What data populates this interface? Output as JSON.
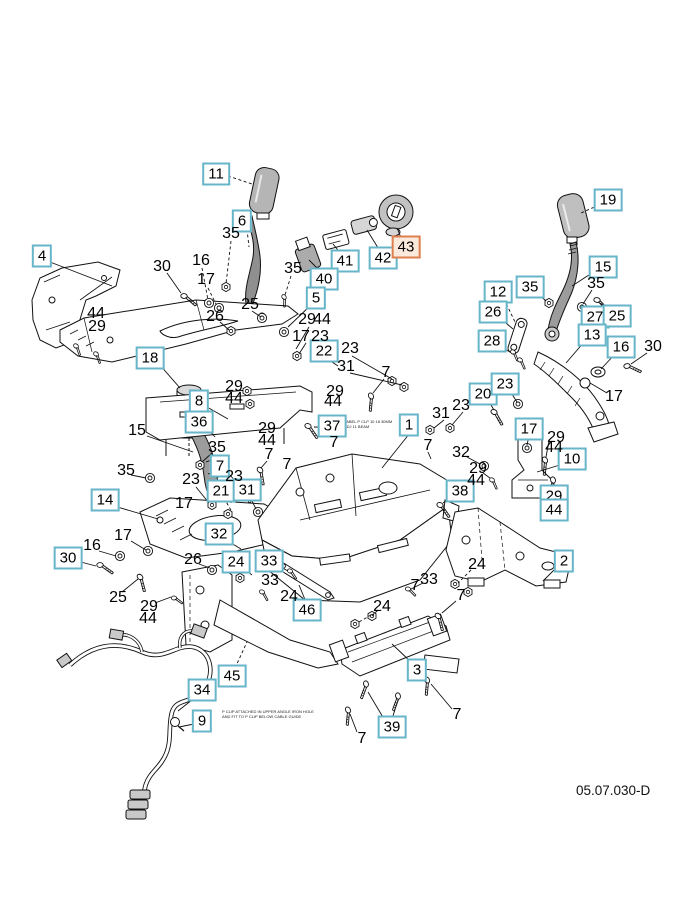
{
  "diagram": {
    "code": "05.07.030-D",
    "colors": {
      "callout_border": "#67b5c8",
      "highlight_border": "#dd7f4e",
      "highlight_bg": "#fbe9dc",
      "ink": "#111111"
    },
    "notes": [
      {
        "x": 344,
        "y": 419,
        "lines": [
          "LABEL P CLP 10 18 30MM",
          "ADJ 11 BEAM"
        ]
      },
      {
        "x": 222,
        "y": 709,
        "lines": [
          "P CLIP ATTACHED IN UPPER ANGLE IRON HOLE",
          "AND FIT TO P CLIP BELOW CABLE GUIDE"
        ]
      }
    ],
    "callouts": [
      {
        "n": "4",
        "x": 42,
        "y": 256,
        "boxed": true
      },
      {
        "n": "11",
        "x": 216,
        "y": 174,
        "boxed": true
      },
      {
        "n": "6",
        "x": 242,
        "y": 221,
        "boxed": true
      },
      {
        "n": "41",
        "x": 345,
        "y": 261,
        "boxed": true
      },
      {
        "n": "42",
        "x": 383,
        "y": 258,
        "boxed": true
      },
      {
        "n": "43",
        "x": 406,
        "y": 247,
        "boxed": true,
        "highlight": true
      },
      {
        "n": "40",
        "x": 324,
        "y": 279,
        "boxed": true
      },
      {
        "n": "5",
        "x": 316,
        "y": 298,
        "boxed": true
      },
      {
        "n": "19",
        "x": 608,
        "y": 200,
        "boxed": true
      },
      {
        "n": "15",
        "x": 603,
        "y": 267,
        "boxed": true
      },
      {
        "n": "35",
        "x": 530,
        "y": 287,
        "boxed": true
      },
      {
        "n": "12",
        "x": 498,
        "y": 292,
        "boxed": true
      },
      {
        "n": "26",
        "x": 493,
        "y": 312,
        "boxed": true
      },
      {
        "n": "27",
        "x": 595,
        "y": 317,
        "boxed": true
      },
      {
        "n": "25",
        "x": 617,
        "y": 316,
        "boxed": true
      },
      {
        "n": "28",
        "x": 492,
        "y": 341,
        "boxed": true
      },
      {
        "n": "13",
        "x": 592,
        "y": 335,
        "boxed": true
      },
      {
        "n": "16",
        "x": 621,
        "y": 347,
        "boxed": true
      },
      {
        "n": "18",
        "x": 150,
        "y": 358,
        "boxed": true
      },
      {
        "n": "8",
        "x": 199,
        "y": 401,
        "boxed": true
      },
      {
        "n": "36",
        "x": 199,
        "y": 422,
        "boxed": true
      },
      {
        "n": "22",
        "x": 324,
        "y": 351,
        "boxed": true
      },
      {
        "n": "37",
        "x": 332,
        "y": 426,
        "boxed": true
      },
      {
        "n": "1",
        "x": 409,
        "y": 425,
        "boxed": true
      },
      {
        "n": "20",
        "x": 483,
        "y": 394,
        "boxed": true
      },
      {
        "n": "23",
        "x": 505,
        "y": 384,
        "boxed": true
      },
      {
        "n": "17",
        "x": 529,
        "y": 429,
        "boxed": true
      },
      {
        "n": "10",
        "x": 572,
        "y": 459,
        "boxed": true
      },
      {
        "n": "38",
        "x": 460,
        "y": 491,
        "boxed": true
      },
      {
        "n": "29",
        "x": 554,
        "y": 496,
        "boxed": true
      },
      {
        "n": "44",
        "x": 554,
        "y": 510,
        "boxed": true
      },
      {
        "n": "7",
        "x": 220,
        "y": 466,
        "boxed": true
      },
      {
        "n": "21",
        "x": 221,
        "y": 491,
        "boxed": true
      },
      {
        "n": "31",
        "x": 247,
        "y": 490,
        "boxed": true
      },
      {
        "n": "14",
        "x": 105,
        "y": 500,
        "boxed": true
      },
      {
        "n": "30",
        "x": 68,
        "y": 558,
        "boxed": true
      },
      {
        "n": "32",
        "x": 219,
        "y": 534,
        "boxed": true
      },
      {
        "n": "24",
        "x": 236,
        "y": 562,
        "boxed": true
      },
      {
        "n": "33",
        "x": 269,
        "y": 561,
        "boxed": true
      },
      {
        "n": "46",
        "x": 307,
        "y": 610,
        "boxed": true
      },
      {
        "n": "2",
        "x": 564,
        "y": 561,
        "boxed": true
      },
      {
        "n": "45",
        "x": 232,
        "y": 676,
        "boxed": true
      },
      {
        "n": "34",
        "x": 202,
        "y": 690,
        "boxed": true
      },
      {
        "n": "9",
        "x": 202,
        "y": 721,
        "boxed": true
      },
      {
        "n": "3",
        "x": 417,
        "y": 670,
        "boxed": true
      },
      {
        "n": "39",
        "x": 392,
        "y": 727,
        "boxed": true
      },
      {
        "n": "30",
        "x": 162,
        "y": 267,
        "boxed": false
      },
      {
        "n": "16",
        "x": 201,
        "y": 261,
        "boxed": false
      },
      {
        "n": "17",
        "x": 206,
        "y": 280,
        "boxed": false
      },
      {
        "n": "35",
        "x": 231,
        "y": 234,
        "boxed": false
      },
      {
        "n": "35",
        "x": 293,
        "y": 269,
        "boxed": false
      },
      {
        "n": "44",
        "x": 96,
        "y": 314,
        "boxed": false
      },
      {
        "n": "29",
        "x": 97,
        "y": 327,
        "boxed": false
      },
      {
        "n": "26",
        "x": 215,
        "y": 317,
        "boxed": false
      },
      {
        "n": "25",
        "x": 250,
        "y": 305,
        "boxed": false
      },
      {
        "n": "29",
        "x": 307,
        "y": 320,
        "boxed": false
      },
      {
        "n": "44",
        "x": 322,
        "y": 320,
        "boxed": false
      },
      {
        "n": "17",
        "x": 301,
        "y": 337,
        "boxed": false
      },
      {
        "n": "23",
        "x": 320,
        "y": 337,
        "boxed": false
      },
      {
        "n": "23",
        "x": 350,
        "y": 349,
        "boxed": false
      },
      {
        "n": "31",
        "x": 346,
        "y": 367,
        "boxed": false
      },
      {
        "n": "7",
        "x": 386,
        "y": 373,
        "boxed": false
      },
      {
        "n": "35",
        "x": 596,
        "y": 284,
        "boxed": false
      },
      {
        "n": "30",
        "x": 653,
        "y": 347,
        "boxed": false
      },
      {
        "n": "17",
        "x": 614,
        "y": 397,
        "boxed": false
      },
      {
        "n": "29",
        "x": 234,
        "y": 387,
        "boxed": false
      },
      {
        "n": "44",
        "x": 234,
        "y": 399,
        "boxed": false
      },
      {
        "n": "29",
        "x": 267,
        "y": 429,
        "boxed": false
      },
      {
        "n": "44",
        "x": 267,
        "y": 441,
        "boxed": false
      },
      {
        "n": "35",
        "x": 217,
        "y": 448,
        "boxed": false
      },
      {
        "n": "7",
        "x": 269,
        "y": 455,
        "boxed": false
      },
      {
        "n": "23",
        "x": 191,
        "y": 480,
        "boxed": false
      },
      {
        "n": "23",
        "x": 234,
        "y": 477,
        "boxed": false
      },
      {
        "n": "29",
        "x": 335,
        "y": 392,
        "boxed": false
      },
      {
        "n": "44",
        "x": 333,
        "y": 402,
        "boxed": false
      },
      {
        "n": "7",
        "x": 334,
        "y": 443,
        "boxed": false
      },
      {
        "n": "7",
        "x": 287,
        "y": 465,
        "boxed": false
      },
      {
        "n": "15",
        "x": 137,
        "y": 431,
        "boxed": false
      },
      {
        "n": "17",
        "x": 184,
        "y": 504,
        "boxed": false
      },
      {
        "n": "17",
        "x": 123,
        "y": 536,
        "boxed": false
      },
      {
        "n": "16",
        "x": 92,
        "y": 546,
        "boxed": false
      },
      {
        "n": "26",
        "x": 193,
        "y": 560,
        "boxed": false
      },
      {
        "n": "25",
        "x": 118,
        "y": 598,
        "boxed": false
      },
      {
        "n": "29",
        "x": 149,
        "y": 607,
        "boxed": false
      },
      {
        "n": "44",
        "x": 148,
        "y": 619,
        "boxed": false
      },
      {
        "n": "35",
        "x": 126,
        "y": 471,
        "boxed": false
      },
      {
        "n": "31",
        "x": 441,
        "y": 414,
        "boxed": false
      },
      {
        "n": "23",
        "x": 461,
        "y": 406,
        "boxed": false
      },
      {
        "n": "7",
        "x": 428,
        "y": 446,
        "boxed": false
      },
      {
        "n": "32",
        "x": 461,
        "y": 453,
        "boxed": false
      },
      {
        "n": "29",
        "x": 478,
        "y": 469,
        "boxed": false
      },
      {
        "n": "44",
        "x": 476,
        "y": 481,
        "boxed": false
      },
      {
        "n": "29",
        "x": 556,
        "y": 438,
        "boxed": false
      },
      {
        "n": "44",
        "x": 554,
        "y": 448,
        "boxed": false
      },
      {
        "n": "33",
        "x": 270,
        "y": 581,
        "boxed": false
      },
      {
        "n": "24",
        "x": 289,
        "y": 597,
        "boxed": false
      },
      {
        "n": "33",
        "x": 429,
        "y": 580,
        "boxed": false
      },
      {
        "n": "7",
        "x": 415,
        "y": 586,
        "boxed": false
      },
      {
        "n": "24",
        "x": 382,
        "y": 607,
        "boxed": false
      },
      {
        "n": "7",
        "x": 461,
        "y": 596,
        "boxed": false
      },
      {
        "n": "24",
        "x": 477,
        "y": 565,
        "boxed": false
      },
      {
        "n": "7",
        "x": 457,
        "y": 715,
        "boxed": false
      },
      {
        "n": "7",
        "x": 362,
        "y": 739,
        "boxed": false
      }
    ]
  }
}
